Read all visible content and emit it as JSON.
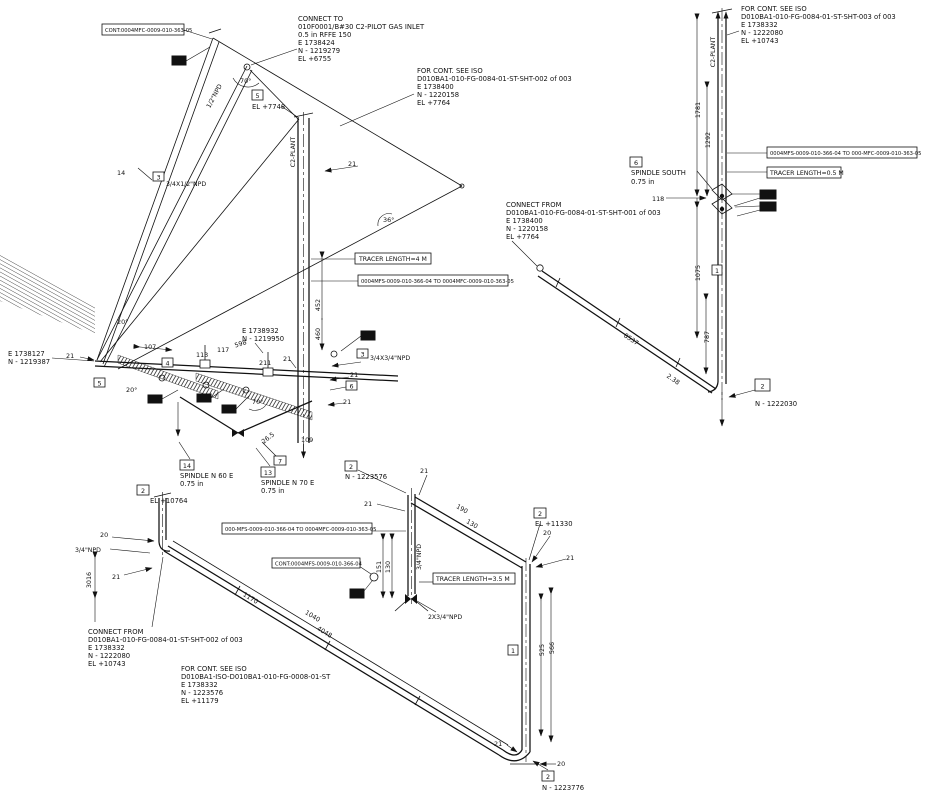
{
  "blocks": {
    "connect_to": [
      "CONNECT TO",
      "010F0001/B#30 C2-PILOT GAS INLET",
      "0.5 in RFFE 150",
      "E 1738424",
      "N - 1219279",
      "EL +6755"
    ],
    "for_cont_sht002": [
      "FOR CONT. SEE ISO",
      "D010BA1-010-FG-0084-01-ST-SHT-002 of 003",
      "E 1738400",
      "N - 1220158",
      "EL +7764"
    ],
    "for_cont_sht003": [
      "FOR CONT. SEE ISO",
      "D010BA1-010-FG-0084-01-ST-SHT-003 of 003",
      "E 1738332",
      "N - 1222080",
      "EL +10743"
    ],
    "connect_from_sht001": [
      "CONNECT FROM",
      "D010BA1-010-FG-0084-01-ST-SHT-001 of 003",
      "E 1738400",
      "N - 1220158",
      "EL +7764"
    ],
    "connect_from_sht002": [
      "CONNECT FROM",
      "D010BA1-010-FG-0084-01-ST-SHT-002 of 003",
      "E 1738332",
      "N - 1222080",
      "EL +10743"
    ],
    "for_cont_iso": [
      "FOR CONT. SEE ISO",
      "D010BA1-ISO-D010BA1-010-FG-0008-01-ST",
      "E 1738332",
      "N - 1223576",
      "EL +11179"
    ],
    "coord_left": [
      "E 1738127",
      "N - 1219387"
    ],
    "coord_mid": [
      "E 1738932",
      "N - 1219950"
    ]
  },
  "callouts": {
    "cont_top_left": "CONT:0004MFC-0009-010-363-05",
    "tracer_4m": "TRACER LENGTH=4 M",
    "line_mid": "0004MFS-0009-010-366-04 TO 0004MFC-0009-010-363-05",
    "line_right": "0004MFS-0009-010-366-04 TO 000-MFC-0009-010-363-05",
    "tracer_05m": "TRACER LENGTH=0.5 M",
    "line_bottom": "000-MFS-0009-010-366-04 TO 0004MFC-0009-010-363-05",
    "cont_bottom": "CONT:0004MFS-0009-010-366-04",
    "tracer_35m": "TRACER LENGTH=3.5 M"
  },
  "spindles": {
    "south": {
      "ref": "6",
      "l1": "SPINDLE SOUTH",
      "l2": "0.75 in"
    },
    "n60e": {
      "ref": "14",
      "l1": "SPINDLE N 60 E",
      "l2": "0.75 in"
    },
    "n70e": {
      "ref": "13",
      "l1": "SPINDLE N 70 E",
      "l2": "0.75 in"
    }
  },
  "els": {
    "el_7748": {
      "ref": "5",
      "text": "EL +7748"
    },
    "el_10764": {
      "ref": "2",
      "text": "EL +10764"
    },
    "el_11330": {
      "ref": "2",
      "text": "EL +11330"
    },
    "n_1223576": {
      "ref": "2",
      "text": "N - 1223576"
    },
    "n_1222030": {
      "ref": "2",
      "text": "N - 1222030"
    },
    "n_1223776": {
      "ref": "2",
      "text": "N - 1223776"
    }
  },
  "markers": {
    "m1": "1",
    "m3": "3",
    "m4": "4",
    "m6": "6",
    "m7": "7"
  },
  "sizes": {
    "npd_34x12": "3/4X1/2\"NPD",
    "npd_34x34": "3/4X3/4\"NPD",
    "npd_34": "3/4\"NPD",
    "npd_2x34": "2X3/4\"NPD",
    "npd_12": "1/2\"NPD",
    "line_name": "C2-PLANT"
  },
  "dims": {
    "d14": "14",
    "d20": "20",
    "d21": "21",
    "d107": "107",
    "d109": "109",
    "d113": "113",
    "d117": "117",
    "d118": "118",
    "d130": "130",
    "d151": "151",
    "d190": "190",
    "d211": "211",
    "d238": "2.38",
    "d265": "26.5",
    "d452": "452",
    "d460": "460",
    "d525": "525",
    "d566": "566",
    "d598": "598",
    "d787": "787",
    "d1040": "1040",
    "d1075": "1075",
    "d1170": "1170",
    "d1292": "1292",
    "d1781": "1781",
    "d3016": "3016",
    "d4048": "4048",
    "d8537": "8537",
    "a20": "20°",
    "a36": "36°",
    "a70": "70°"
  }
}
